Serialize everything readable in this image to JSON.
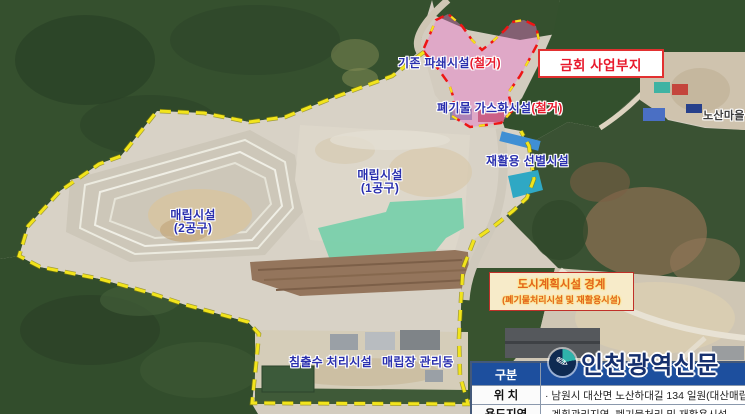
{
  "map": {
    "labels": {
      "existing_crusher": "기존 파쇄시설",
      "existing_crusher_suffix": "(철거)",
      "gasification": "폐기물 가스화시설",
      "gasification_suffix": "(철거)",
      "recycling": "재활용 선별시설",
      "landfill_1_name": "매립시설",
      "landfill_1_section": "(1공구)",
      "landfill_2_name": "매립시설",
      "landfill_2_section": "(2공구)",
      "leachate": "침출수 처리시설",
      "management": "매립장 관리동",
      "village": "노산마을"
    },
    "callouts": {
      "project_site": "금회 사업부지",
      "boundary_title": "도시계획시설 경계",
      "boundary_subtitle": "(폐기물처리시설 및 재활용시설)"
    }
  },
  "table": {
    "header": {
      "col1": "구분"
    },
    "rows": [
      {
        "label": "위 치",
        "value": "· 남원시 대산면 노산하대길 134 일원(대산매립장 내"
      },
      {
        "label": "용도지역",
        "value": "· 계획관리지역, 폐기물처리 및 재활용시설"
      }
    ]
  },
  "watermark": {
    "name": "인천광역신문"
  },
  "colors": {
    "boundary_yellow": "#f2e41c",
    "boundary_red": "#ee1515",
    "site_pink": "#f078d2",
    "label_blue": "#2a2fae",
    "demolish_red": "#e8192c",
    "table_header_blue": "#1d4f9e",
    "callout_cream": "#f7ebc9",
    "callout_orange": "#e2641e"
  }
}
